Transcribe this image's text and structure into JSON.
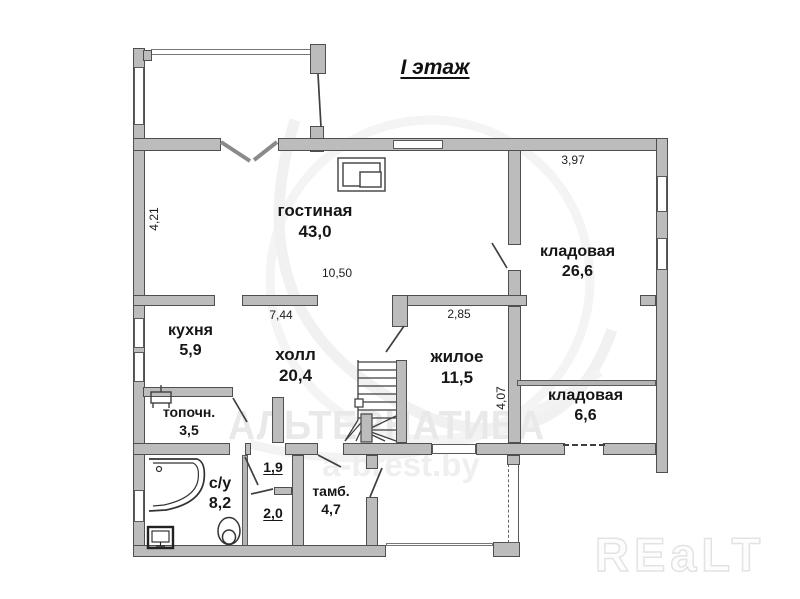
{
  "title": "I этаж",
  "rooms": {
    "living": {
      "name": "гостиная",
      "area": "43,0"
    },
    "storage_big": {
      "name": "кладовая",
      "area": "26,6"
    },
    "kitchen": {
      "name": "кухня",
      "area": "5,9"
    },
    "hall": {
      "name": "холл",
      "area": "20,4"
    },
    "bedroom": {
      "name": "жилое",
      "area": "11,5"
    },
    "storage_small": {
      "name": "кладовая",
      "area": "6,6"
    },
    "boiler_room": {
      "name": "топочн.",
      "area": "3,5"
    },
    "bathroom": {
      "name": "с/у",
      "area": "8,2"
    },
    "vestibule": {
      "name": "тамб.",
      "area": "4,7"
    },
    "closet_a": {
      "area": "1,9"
    },
    "closet_b": {
      "area": "2,0"
    }
  },
  "dimensions": {
    "living_height": "4,21",
    "storage_width": "3,97",
    "living_width": "10,50",
    "hall_width": "7,44",
    "bedroom_width": "2,85",
    "right_section_height": "4,07"
  },
  "watermark": {
    "agency": "АЛЬТЕРНАТИВА",
    "site": "a-brest.by",
    "logo": "REaLT"
  },
  "colors": {
    "wall_fill": "#bcbcbc",
    "wall_border": "#4f4f4f",
    "line": "#3f3f3f",
    "watermark": "#e9e9e9"
  }
}
